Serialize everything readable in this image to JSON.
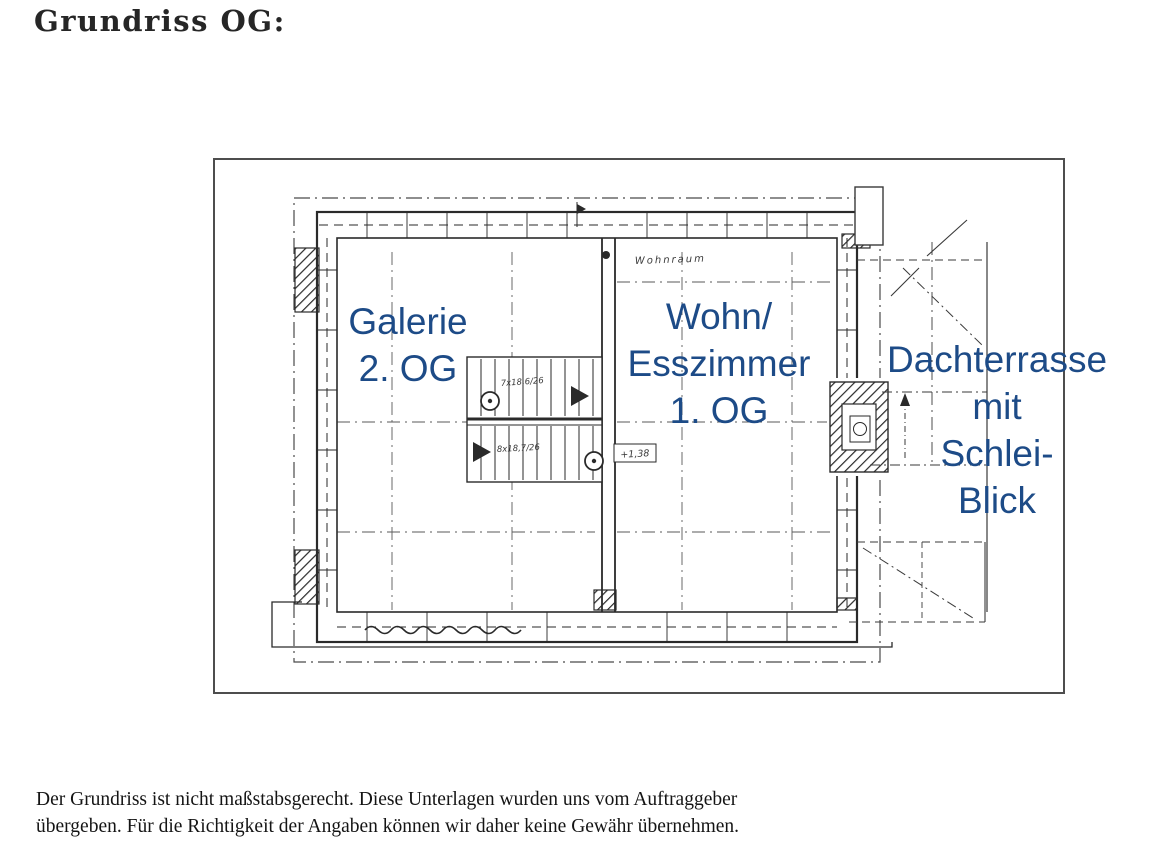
{
  "page": {
    "title": "Grundriss OG:",
    "disclaimer": {
      "line1": "Der Grundriss ist nicht maßstabsgerecht. Diese Unterlagen wurden uns vom Auftraggeber",
      "line2": "übergeben. Für die Richtigkeit der Angaben können wir daher keine Gewähr übernehmen."
    }
  },
  "floorplan": {
    "rooms": [
      {
        "name": "galerie",
        "lines": [
          "Galerie",
          "2. OG"
        ]
      },
      {
        "name": "wohn-esszimmer",
        "lines": [
          "Wohn/",
          "Esszimmer",
          "1. OG"
        ]
      },
      {
        "name": "dachterrasse",
        "lines": [
          "Dachterrasse",
          "mit",
          "Schlei-",
          "Blick"
        ]
      }
    ],
    "annotations": {
      "room_note": "Wohnraum",
      "stair_upper": "7x18,6/26",
      "stair_lower": "8x18,7/26",
      "level_mark": "+1,38"
    },
    "colors": {
      "label_blue": "#1d4b87",
      "ink": "#2a2a2a"
    }
  }
}
